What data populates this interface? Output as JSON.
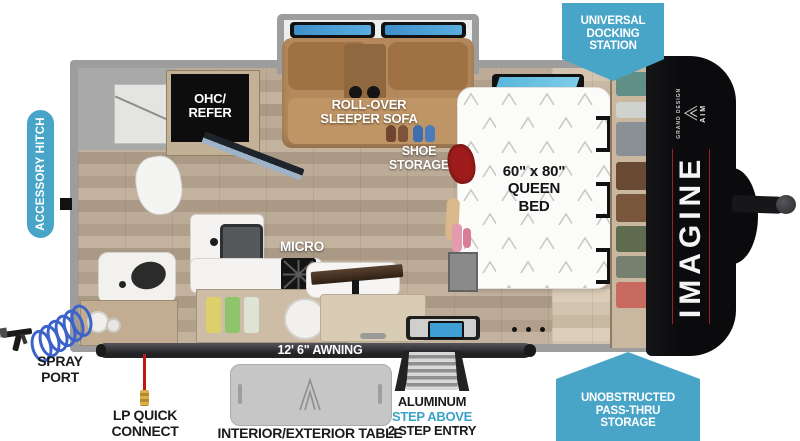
{
  "badges": {
    "universal_docking": {
      "line1": "UNIVERSAL",
      "line2": "DOCKING",
      "line3": "STATION"
    },
    "accessory_hitch": "ACCESSORY HITCH",
    "pass_thru": {
      "line1": "UNOBSTRUCTED",
      "line2": "PASS-THRU",
      "line3": "STORAGE"
    }
  },
  "exterior_labels": {
    "spray_port": {
      "line1": "SPRAY",
      "line2": "PORT"
    },
    "lp_quick_connect": {
      "line1": "LP QUICK",
      "line2": "CONNECT"
    },
    "table": "INTERIOR/EXTERIOR TABLE",
    "awning": "12' 6\" AWNING",
    "step": {
      "line1": "ALUMINUM",
      "line2": "STEP ABOVE",
      "line3": "2 STEP ENTRY"
    }
  },
  "interior_labels": {
    "ohc_refer": {
      "line1": "OHC/",
      "line2": "REFER"
    },
    "sofa": {
      "line1": "ROLL-OVER",
      "line2": "SLEEPER SOFA"
    },
    "shoe_storage": {
      "line1": "SHOE",
      "line2": "STORAGE"
    },
    "bed": {
      "line1": "60\" x 80\"",
      "line2": "QUEEN",
      "line3": "BED"
    },
    "micro": "MICRO"
  },
  "brand": {
    "name": "IMAGINE",
    "maker": "GRAND DESIGN",
    "model": "AIM"
  },
  "colors": {
    "badge_blue": "#49a5c8",
    "accent_blue_text": "#3aa2c6",
    "window_blue": "#3f8fc9",
    "hose_blue": "#3c63c9",
    "cap_black": "#0b0b0d",
    "awning_dark": "#2b2b2e",
    "label_black": "#1b1b1b",
    "sofa_brown": "#b4895c",
    "floor_wood": "#b3a28d",
    "brand_red": "#a11f1f",
    "lp_red": "#c01818"
  }
}
